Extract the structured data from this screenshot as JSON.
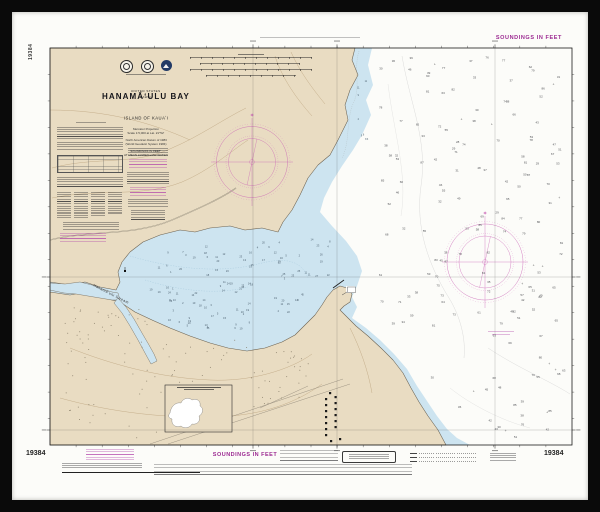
{
  "chart": {
    "number": "19384",
    "title_block": {
      "country": "UNITED STATES",
      "state": "HAWAII",
      "title": "HANAMĀʻULU BAY",
      "subtitle": "ISLAND OF KAUAʻI",
      "proj1": "Mercator Projection",
      "proj2": "Scale 1:5,000 at Lat. 21°52'",
      "datum1": "North American Datum of 1983",
      "datum2": "(World Geodetic System 1984)",
      "sound1": "SOUNDINGS IN FEET",
      "sound2": "AT MEAN LOWER LOW WATER"
    },
    "labels": {
      "stream": "Hanamāʻulu Stream"
    }
  },
  "margins": {
    "top_right_label": "SOUNDINGS IN FEET",
    "left_vertical_number": "19384",
    "bottom": {
      "left_number": "19384",
      "center_label": "SOUNDINGS IN FEET",
      "right_number": "19384"
    }
  },
  "colors": {
    "frame": "#0a0a0a",
    "paper": "#fcfcf9",
    "land": "#e9dcc2",
    "shallow_water": "#cde4f0",
    "deep_water": "#ffffff",
    "magenta_label": "#9c2a92",
    "compass_rose": "#c95fb4",
    "coastline": "#6b6150"
  }
}
